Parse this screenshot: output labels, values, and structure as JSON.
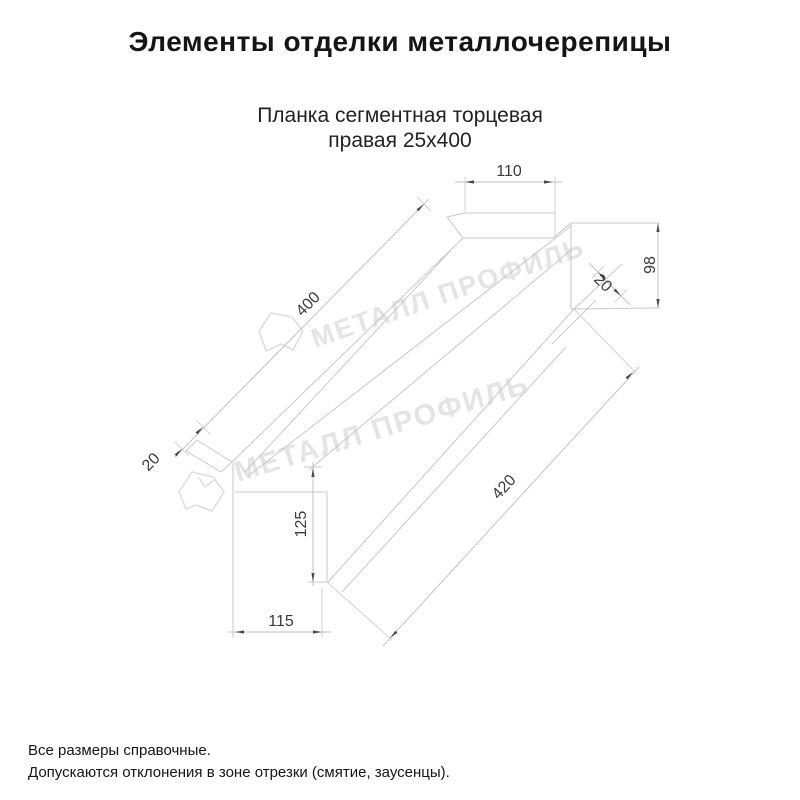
{
  "header": {
    "title": "Элементы отделки металлочерепицы"
  },
  "drawing": {
    "subtitle_line1": "Планка сегментная торцевая",
    "subtitle_line2": "правая 25х400",
    "dimensions": {
      "top_flange_width": "110",
      "end_height": "98",
      "end_hem": "20",
      "top_length": "400",
      "left_hem": "20",
      "left_end_height": "125",
      "bottom_length": "420",
      "left_end_width": "115"
    },
    "watermark": {
      "text": "МЕТАЛЛ ПРОФИЛЬ",
      "color": "#e4e4e4"
    },
    "line_color": "#c8c8c8",
    "dim_text_color": "#3a3a3a"
  },
  "footer": {
    "line1": "Все размеры справочные.",
    "line2": "Допускаются отклонения в зоне отрезки (смятие, заусенцы)."
  }
}
